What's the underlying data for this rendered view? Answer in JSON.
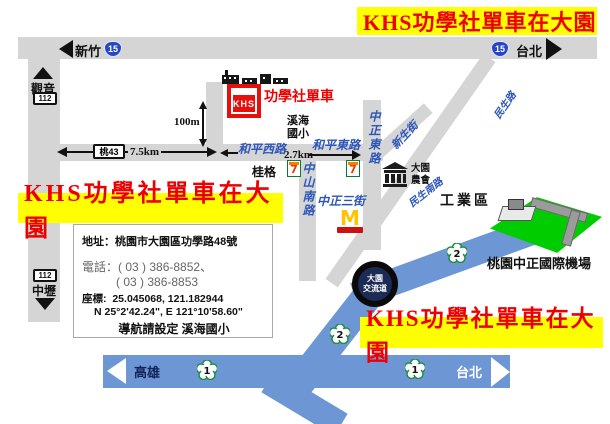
{
  "banners": {
    "text": "KHS功學社單車在大園"
  },
  "store": {
    "brand": "KHS",
    "name": "功學社單車"
  },
  "shields": {
    "route15": "15",
    "route112": "112",
    "tao43": "桃43",
    "freeway1": "1",
    "freeway2": "2",
    "interchange_line1": "大園",
    "interchange_line2": "交流道"
  },
  "destinations": {
    "xinzhu": "新竹",
    "taipei_top": "台北",
    "guanyin": "觀音",
    "zhongli": "中壢",
    "kaohsiung": "高雄",
    "taipei_bottom": "台北"
  },
  "distances": {
    "d100m": "100m",
    "d7_5km": "7.5km",
    "d2_7km": "2.7km"
  },
  "streets": {
    "heping_west": "和平西路",
    "heping_east": "和平東路",
    "zhongshan_south": "中山南路",
    "zhongzheng_3rd": "中正三街",
    "zhongzheng_east": "中正東路",
    "xinsheng": "新生街",
    "minsheng": "民生路",
    "minsheng_south": "民生南路"
  },
  "landmarks": {
    "school_line1": "溪海",
    "school_line2": "國小",
    "quaker": "桂格",
    "farmers_line1": "大園",
    "farmers_line2": "農會",
    "industrial": "工業區",
    "airport": "桃園中正國際機場",
    "seven": "7",
    "mcdonalds": "M"
  },
  "info_box": {
    "address_label": "地址：",
    "address": "桃園市大園區功學路48號",
    "phone_label": "電話：",
    "phone1": "( 03 ) 386-8852、",
    "phone2": "( 03 ) 386-8853",
    "coord_label": "座標:",
    "coord_decimal": "25.045068, 121.182944",
    "coord_dms": "N 25°2'42.24\", E 121°10'58.60\"",
    "nav_note": "導航請設定 溪海國小"
  }
}
